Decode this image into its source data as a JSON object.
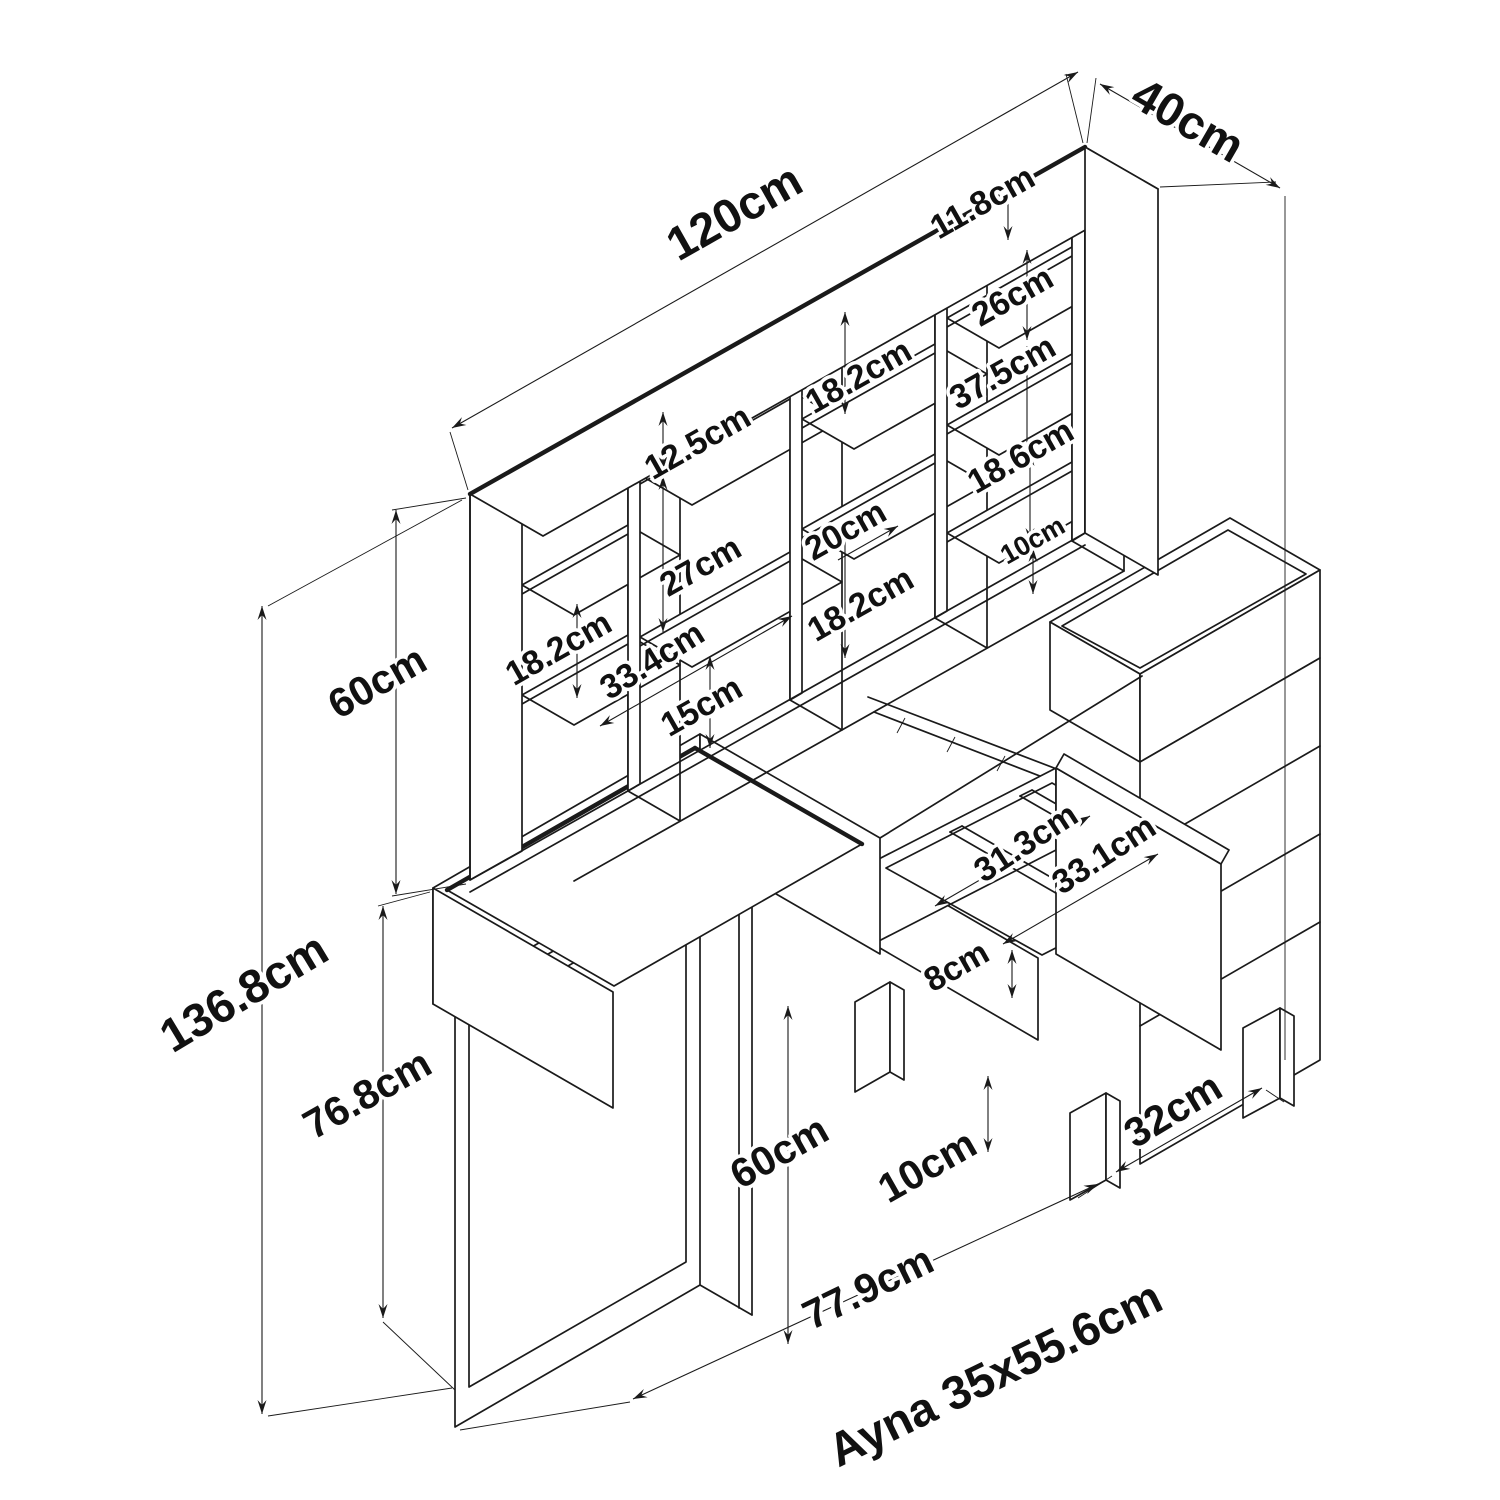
{
  "drawing": {
    "overall": {
      "width": "120cm",
      "depth": "40cm",
      "total_height": "136.8cm",
      "hutch_height": "60cm",
      "base_height": "76.8cm"
    },
    "hutch": {
      "top_gap": "11.8cm",
      "col1_shelf_gap": "18.2cm",
      "col2_top_gap": "12.5cm",
      "col2_mid_gap": "27cm",
      "col2_shelf_width": "33.4cm",
      "col2_bottom_gap": "15cm",
      "col3_top_gap": "18.2cm",
      "col3_shelf_width": "20cm",
      "col3_bottom_gap": "18.2cm",
      "col4_top_opening": "26cm",
      "col4_gap_1": "37.5cm",
      "col4_gap_2": "18.6cm",
      "col4_bottom_gap": "10cm"
    },
    "drawer": {
      "inner_width": "31.3cm",
      "inner_depth": "33.1cm",
      "side_height": "8cm"
    },
    "base": {
      "open_height": "60cm",
      "leg_height": "10cm",
      "leg_spacing": "32cm",
      "table_width": "77.9cm"
    },
    "mirror_note": "Ayna 35x55.6cm",
    "colors": {
      "line": "#1a1a1a",
      "background": "#ffffff"
    }
  }
}
